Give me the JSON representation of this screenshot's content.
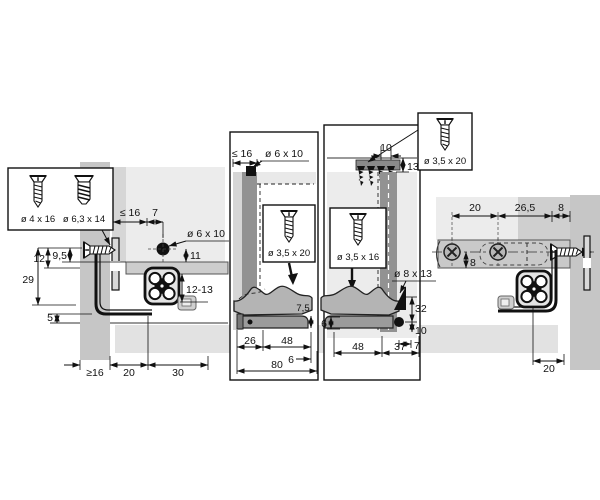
{
  "boxes": {
    "left_a": "ø 4 x 16",
    "left_b": "ø 6,3 x 14",
    "front": "ø 3,5 x 20",
    "rear": "ø 3,5 x 16",
    "top_right": "ø 3,5 x 20"
  },
  "left_view": {
    "le16": "≤ 16",
    "n7": "7",
    "hole": "ø 6 x 10",
    "n11": "11",
    "n12_13": "12-13",
    "n12": "12",
    "n9_5": "9,5",
    "n29": "29",
    "n5": "5",
    "ge16": "≥16",
    "n20": "20",
    "n30": "30"
  },
  "front_view": {
    "le16": "≤ 16",
    "hole": "ø 6 x 10",
    "n7_5": "7,5",
    "n26": "26",
    "n48": "48",
    "n6": "6",
    "n80": "80"
  },
  "rear_view": {
    "n10": "10",
    "n13": "13",
    "hole": "ø 8 x 13",
    "n32": "32",
    "n10b": "10",
    "n7": "7",
    "n6": "6",
    "n48": "48",
    "n37": "37"
  },
  "right_view": {
    "n20": "20",
    "n26_5": "26,5",
    "n8": "8",
    "n8v": "8",
    "n20b": "20"
  },
  "colors": {
    "panel": "#c6c6c6",
    "panel_mid": "#d6d6d6",
    "panel_dark": "#929292",
    "interior": "#ececec",
    "interior2": "#e9e9e9",
    "metal": "#b4b4b4",
    "rail": "#9b9b9b",
    "railface": "#c9c9c9",
    "strip": "#e2e2e2",
    "line": "#111111"
  }
}
